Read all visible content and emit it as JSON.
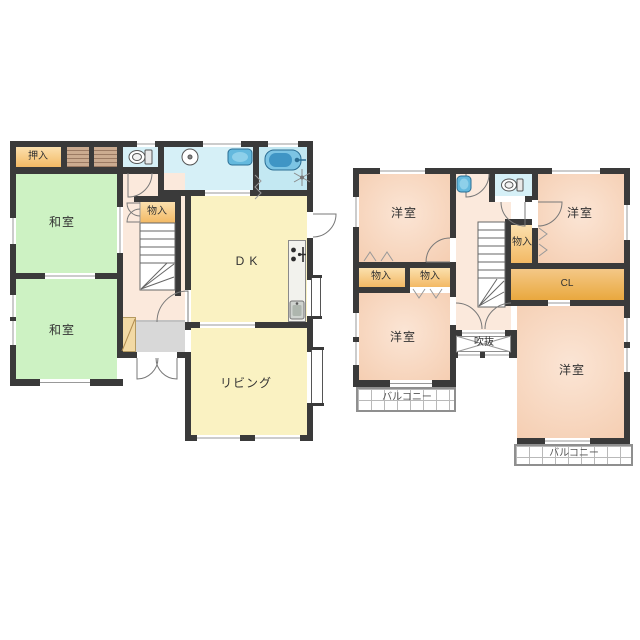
{
  "colors": {
    "wall": "#3a3a3a",
    "tatami_green": "#cdf2c3",
    "western_pink": "#f5ceb2",
    "storage_orange": "#f3b964",
    "closet_orange": "#e9a83e",
    "room_yellow": "#faf2c2",
    "hall_pink": "#fbe9dc",
    "sanitary_blue": "#d6f0f7",
    "bath_blue": "#c3e8f2",
    "entrance_grey": "#d8d8d8"
  },
  "floor1": {
    "labels": {
      "oshiire": "押入",
      "washitsu_upper": "和室",
      "washitsu_lower": "和室",
      "monoire": "物入",
      "dk": "DK",
      "living": "リビング"
    }
  },
  "floor2": {
    "labels": {
      "yoshitsu_top_left": "洋室",
      "yoshitsu_top_right": "洋室",
      "yoshitsu_mid_left": "洋室",
      "yoshitsu_bottom_right": "洋室",
      "monoire_left": "物入",
      "monoire_mid": "物入",
      "monoire_right": "物入",
      "closet": "CL",
      "void": "吹抜",
      "balcony_left": "バルコニー",
      "balcony_right": "バルコニー"
    }
  },
  "icons": [
    "toilet-icon-1f",
    "toilet-icon-2f",
    "sink-icon",
    "washbasin-icon-1f",
    "washbasin-icon-2f",
    "bathtub-icon",
    "fan-icon",
    "stove-icon",
    "kitchen-sink-icon",
    "staircase-1f",
    "staircase-2f",
    "door-arcs",
    "void-cross"
  ]
}
